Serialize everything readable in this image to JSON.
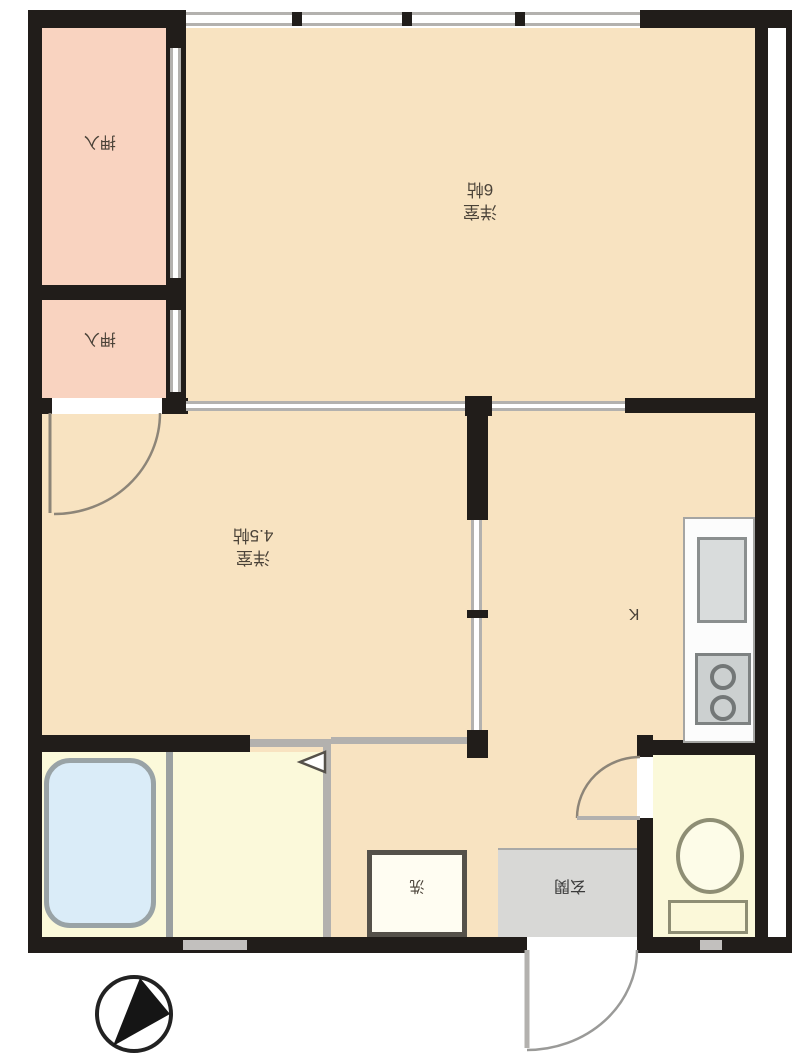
{
  "title": "apartment-floor-plan",
  "rooms": {
    "closet_top": {
      "label": "押入"
    },
    "closet_bottom": {
      "label": "押入"
    },
    "bedroom_6": {
      "name_label": "洋室",
      "size_label": "6帖"
    },
    "bedroom_45": {
      "name_label": "洋室",
      "size_label": "4.5帖"
    },
    "kitchen": {
      "label": "K"
    },
    "laundry": {
      "label": "洗"
    },
    "entrance": {
      "label": "玄関"
    }
  },
  "fixtures": [
    "bathtub",
    "kitchen-sink",
    "two-burner-stove",
    "toilet",
    "washing-machine-space",
    "entrance-door",
    "room-doors",
    "sliding-doors",
    "window"
  ],
  "compass": {
    "type": "north-arrow",
    "direction": "upper-right"
  },
  "colors": {
    "room_beige": "#f8e3c1",
    "closet_pink": "#f9d3c0",
    "wet_area_cream": "#fbf9da",
    "entrance_gray": "#d8d8d6",
    "tub_blue": "#daecf8",
    "wall_black": "#211d1a",
    "fixture_gray": "#d9dcdc"
  }
}
